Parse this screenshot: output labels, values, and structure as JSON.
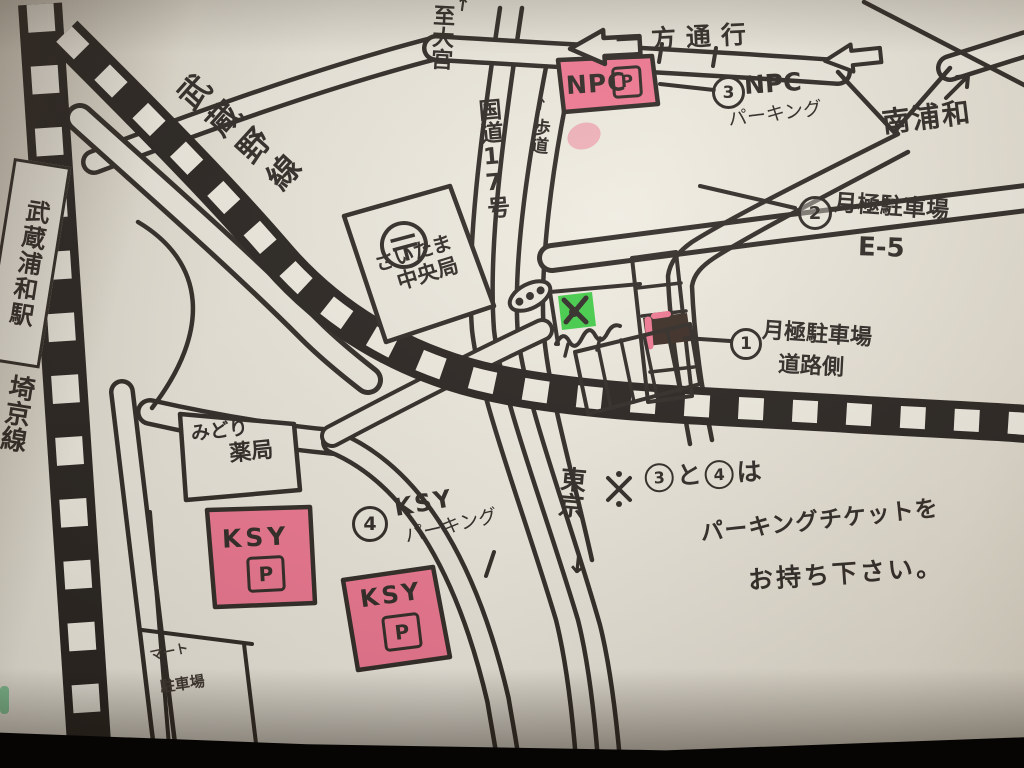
{
  "photo": {
    "description": "hand-drawn parking guide map around Musashi-Urawa station",
    "colors": {
      "paper": "#eae6da",
      "ink": "#2a241f",
      "pink": "#f0748f",
      "green": "#3ecb44",
      "vignette": "#060504"
    }
  },
  "railways": {
    "saikyo_label": "埼京線",
    "musashino_label": "武蔵野線",
    "station_label": "武蔵浦和駅"
  },
  "roads": {
    "route17": "国道17号",
    "to_omiya": "至大宮",
    "to_omiya_arrow": "↑",
    "side_lane": "歩道",
    "side_lane_arrow": "↑",
    "to_tokyo": "東京",
    "to_tokyo_arrow": "↓",
    "one_way": "一方通行",
    "minami_urawa": "南浦和"
  },
  "buildings": {
    "post_office_mark": "〒",
    "post_office_line1": "さいたま",
    "post_office_line2": "中央局",
    "midori_line1": "みどり",
    "midori_line2": "薬局",
    "mart_line1": "マート",
    "mart_line2": "駐車場"
  },
  "parking": {
    "p1_num": "1",
    "p1_name": "月極駐車場",
    "p1_sub": "道路側",
    "p2_num": "2",
    "p2_name": "月極駐車場",
    "p2_sub": "E-5",
    "p3_num": "3",
    "p3_name": "NPC",
    "p3_sub": "パーキング",
    "p4_num": "4",
    "p4_name": "KSY",
    "p4_sub": "パーキング",
    "npc_label": "NPC",
    "ksy_label": "KSY",
    "p_mark": "P"
  },
  "note": {
    "mark": "※",
    "n3": "3",
    "and": "と",
    "n4": "4",
    "suffix": "は",
    "line2": "パーキングチケットを",
    "line3": "お持ち下さい。"
  }
}
